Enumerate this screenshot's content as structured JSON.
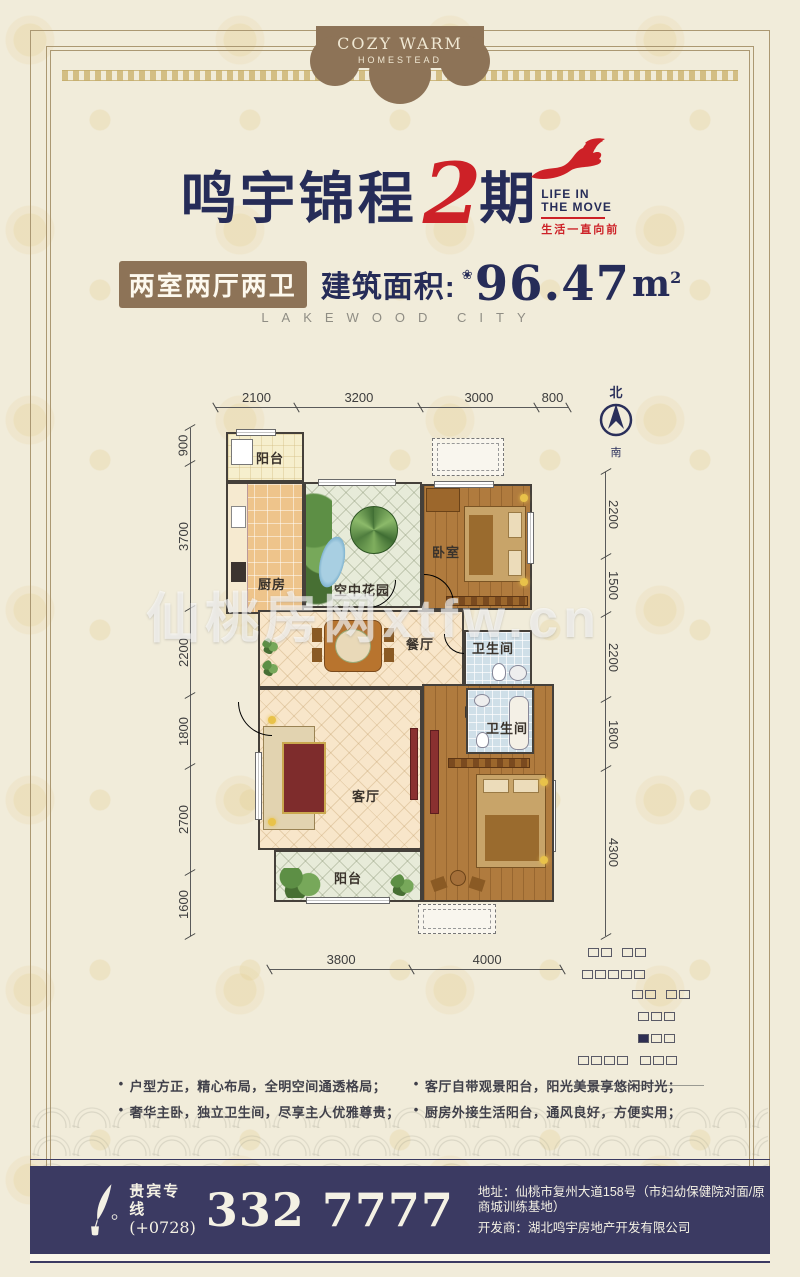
{
  "badge": {
    "line1": "COZY WARM",
    "line2": "HOMESTEAD"
  },
  "title": {
    "name": "鸣宇锦程",
    "phase": "2",
    "suffix": "期",
    "slogan_line1": "LIFE IN",
    "slogan_line2": "THE MOVE",
    "slogan_cn": "生活一直向前"
  },
  "spec": {
    "rooms_badge": "两室两厅两卫",
    "area_label": "建筑面积:",
    "flower_icon": "❀",
    "area_value": "96.47",
    "area_unit": "m",
    "area_sup": "2"
  },
  "subtitle": "LAKEWOOD CITY",
  "compass": {
    "north": "北",
    "south": "南"
  },
  "dims": {
    "top": [
      "2100",
      "3200",
      "3000",
      "800"
    ],
    "left": [
      "900",
      "3700",
      "2200",
      "1800",
      "2700",
      "1600"
    ],
    "right": [
      "2200",
      "1500",
      "2200",
      "1800",
      "4300"
    ],
    "bottom": [
      "3800",
      "4000"
    ]
  },
  "rooms": {
    "balcony_top": "阳台",
    "kitchen": "厨房",
    "sky_garden": "空中花园",
    "bedroom_top": "卧室",
    "bath_top": "卫生间",
    "dining": "餐厅",
    "bath_mid": "卫生间",
    "living": "客厅",
    "bedroom_bottom": "卧室",
    "balcony_bottom": "阳台"
  },
  "watermark": "仙桃房网xtfw.cn",
  "features": {
    "bullet": "•",
    "col1": [
      "户型方正，精心布局，全明空间通透格局；",
      "奢华主卧，独立卫生间，尽享主人优雅尊贵；"
    ],
    "col2": [
      "客厅自带观景阳台，阳光美景享悠闲时光；",
      "厨房外接生活阳台，通风良好，方便实用；"
    ]
  },
  "footer": {
    "vip_label": "贵宾专线",
    "vip_code": "(+0728)",
    "phone": "332 7777",
    "address": "地址：仙桃市复州大道158号（市妇幼保健院对面/原商城训练基地）",
    "developer": "开发商：湖北鸣宇房地产开发有限公司"
  },
  "colors": {
    "navy": "#262c58",
    "red": "#cd2127",
    "brown": "#8d7357",
    "bar_navy": "#3b3a62"
  }
}
